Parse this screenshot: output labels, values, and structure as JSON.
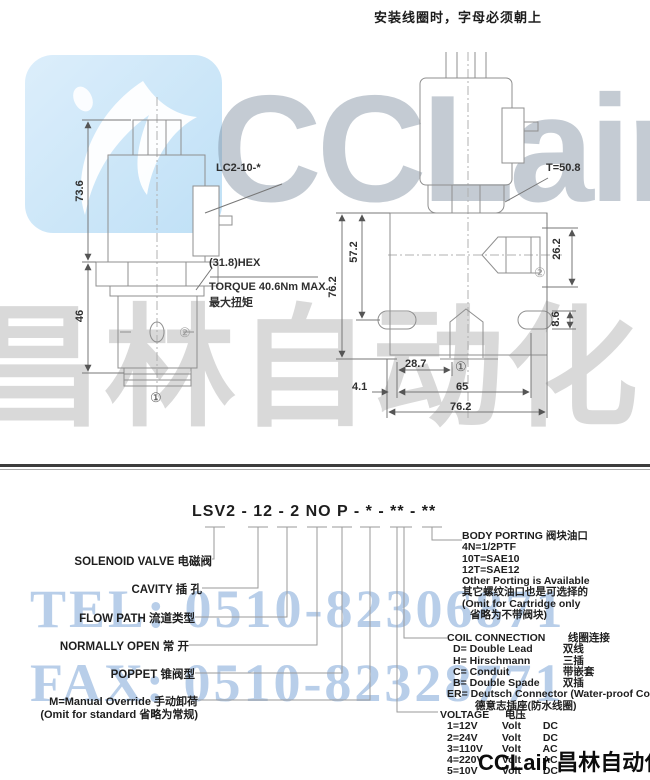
{
  "top_note": "安装线圈时，字母必须朝上",
  "left_view": {
    "dim_73_6": "73.6",
    "dim_46": "46",
    "coil_model": "LC2-10-*",
    "hex": "(31.8)HEX",
    "torque": "TORQUE 40.6Nm MAX.",
    "torque_cn": "最大扭矩",
    "port1": "①",
    "port2": "②"
  },
  "right_view": {
    "t_torque": "T=50.8",
    "dim_76_2": "76.2",
    "dim_57_2": "57.2",
    "dim_26_2": "26.2",
    "dim_8_6": "8.6",
    "dim_28_7": "28.7",
    "dim_4_1": "4.1",
    "dim_65": "65",
    "dim_76_2_bottom": "76.2",
    "port1": "①",
    "port2": "②"
  },
  "model_code": "LSV2 - 12 - 2 NO P - * - ** - **",
  "callouts": {
    "solenoid_valve": "SOLENOID VALVE  电磁阀",
    "cavity": "CAVITY  插 孔",
    "flow_path": "FLOW PATH  流道类型",
    "normally_open": "NORMALLY OPEN  常 开",
    "poppet": "POPPET  锥阀型",
    "manual_override": "M=Manual Override  手动卸荷",
    "manual_override_note": "(Omit for standard 省略为常规)"
  },
  "body_porting": {
    "title": "BODY PORTING 阀块油口",
    "lines": [
      "4N=1/2PTF",
      "10T=SAE10",
      "12T=SAE12",
      "Other Porting is Available",
      "其它螺纹油口也是可选择的",
      "(Omit for Cartridge only",
      "省略为不带阀块)"
    ]
  },
  "coil_connection": {
    "title": "COIL CONNECTION",
    "title_cn": "线圈连接",
    "options": [
      {
        "code": "D= Double Lead",
        "cn": "双线"
      },
      {
        "code": "H= Hirschmann",
        "cn": "三插"
      },
      {
        "code": "C= Conduit",
        "cn": "带嵌套"
      },
      {
        "code": "B= Double Spade",
        "cn": "双插"
      }
    ],
    "er": "ER= Deutsch Connector (Water-proof Coil)",
    "er_cn": "德意志插座(防水线圈)"
  },
  "voltage": {
    "title": "VOLTAGE",
    "title_cn": "电压",
    "options": [
      {
        "code": "1=12V",
        "unit": "Volt",
        "type": "DC"
      },
      {
        "code": "2=24V",
        "unit": "Volt",
        "type": "DC"
      },
      {
        "code": "3=110V",
        "unit": "Volt",
        "type": "AC"
      },
      {
        "code": "4=220V",
        "unit": "Volt",
        "type": "AC"
      },
      {
        "code": "5=10V",
        "unit": "Volt",
        "type": "DC"
      }
    ]
  },
  "watermark": {
    "brand": "CCLair",
    "brand_cn": "昌林自动化",
    "tel": "TEL: 0510-82306871",
    "fax": "FAX: 0510-82328771",
    "footer": "CCLair 昌林自动化"
  }
}
